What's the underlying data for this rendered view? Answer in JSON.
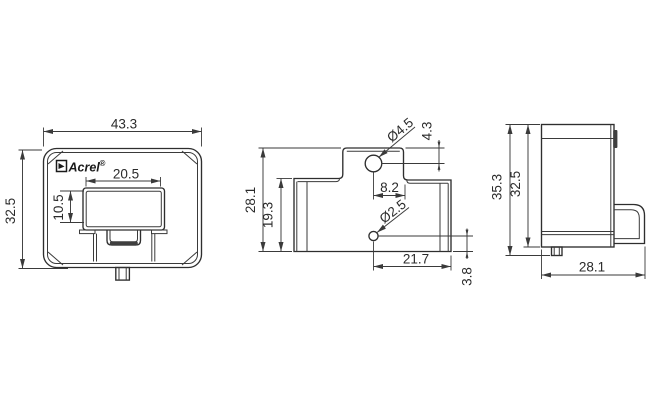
{
  "brand": {
    "name": "Acrel",
    "mark": "®"
  },
  "front_view": {
    "width": "43.3",
    "height": "32.5",
    "window_width": "20.5",
    "window_height": "10.5"
  },
  "top_view": {
    "overall_height": "28.1",
    "inner_height": "19.3",
    "hole_dia_large": "Ø4.5",
    "hole_top_offset": "4.3",
    "hole_edge_dist": "8.2",
    "hole_dia_small": "Ø2.5",
    "hole_right_span": "21.7",
    "hole_bottom_offset": "3.8"
  },
  "side_view": {
    "overall_height": "35.3",
    "body_height": "32.5",
    "depth": "28.1"
  },
  "colors": {
    "line": "#2e2e2e",
    "background": "#ffffff",
    "shading": "#3f3f3f"
  }
}
